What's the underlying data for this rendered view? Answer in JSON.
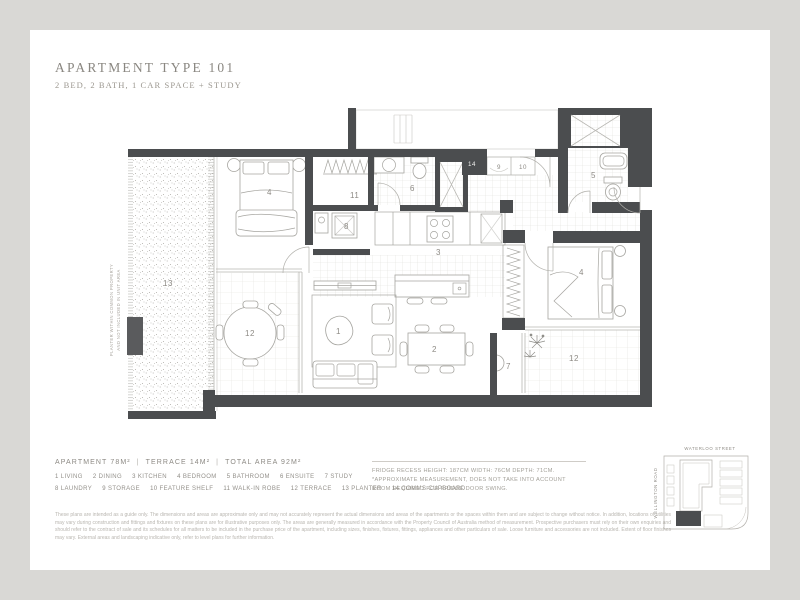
{
  "header": {
    "title": "APARTMENT TYPE 101",
    "subtitle": "2 BED, 2 BATH, 1 CAR SPACE + STUDY"
  },
  "areas": {
    "apartment": "APARTMENT 78M²",
    "terrace": "TERRACE 14M²",
    "total": "TOTAL AREA 92M²",
    "sep": "|"
  },
  "legend": {
    "row1": [
      {
        "num": "1",
        "label": "LIVING"
      },
      {
        "num": "2",
        "label": "DINING"
      },
      {
        "num": "3",
        "label": "KITCHEN"
      },
      {
        "num": "4",
        "label": "BEDROOM"
      },
      {
        "num": "5",
        "label": "BATHROOM"
      },
      {
        "num": "6",
        "label": "ENSUITE"
      },
      {
        "num": "7",
        "label": "STUDY"
      }
    ],
    "row2": [
      {
        "num": "8",
        "label": "LAUNDRY"
      },
      {
        "num": "9",
        "label": "STORAGE"
      },
      {
        "num": "10",
        "label": "FEATURE SHELF"
      },
      {
        "num": "11",
        "label": "WALK-IN ROBE"
      },
      {
        "num": "12",
        "label": "TERRACE"
      },
      {
        "num": "13",
        "label": "PLANTER"
      },
      {
        "num": "14",
        "label": "COMMS CUPBOARD"
      }
    ]
  },
  "fridge_note": "FRIDGE RECESS HEIGHT: 187CM WIDTH: 76CM DEPTH: 71CM. *APPROXIMATE MEASUREMENT, DOES NOT TAKE INTO ACCOUNT ROOM REQUIRED FOR FRIDGE DOOR SWING.",
  "plan": {
    "labels": {
      "living": "1",
      "dining": "2",
      "kitchen": "3",
      "bedroom1": "4",
      "bedroom2": "4",
      "bathroom": "5",
      "ensuite": "6",
      "study": "7",
      "laundry": "8",
      "storage": "9",
      "feature_shelf": "10",
      "robe": "11",
      "terrace_left": "12",
      "terrace_right": "12",
      "planter": "13",
      "comms": "14"
    },
    "planter_note_line1": "PLANTER WITHIN COMMON PROPERTY",
    "planter_note_line2": "AND NOT INCLUDED IN UNIT AREA",
    "wall_color": "#4b4d4f"
  },
  "map": {
    "street_top": "WATERLOO STREET",
    "street_left": "WELLINGTON ROAD"
  },
  "disclaimer": "These plans are intended as a guide only. The dimensions and areas are approximate only and may not accurately represent the actual dimensions and areas of the apartments or the spaces within them and are subject to change without notice. In addition, locations of utilities may vary during construction and fittings and fixtures on these plans are for illustrative purposes only. The areas are generally measured in accordance with the Property Council of Australia method of measurement. Prospective purchasers must rely on their own enquiries and should refer to the contract of sale and its schedules for all matters to be included in the purchase price of the apartment, including sizes, finishes, fixtures, fittings, appliances and other particulars of sale. Loose furniture and accessories are not included. Extent of floor finishes may vary. External areas and landscaping indicative only, refer to level plans for further information."
}
